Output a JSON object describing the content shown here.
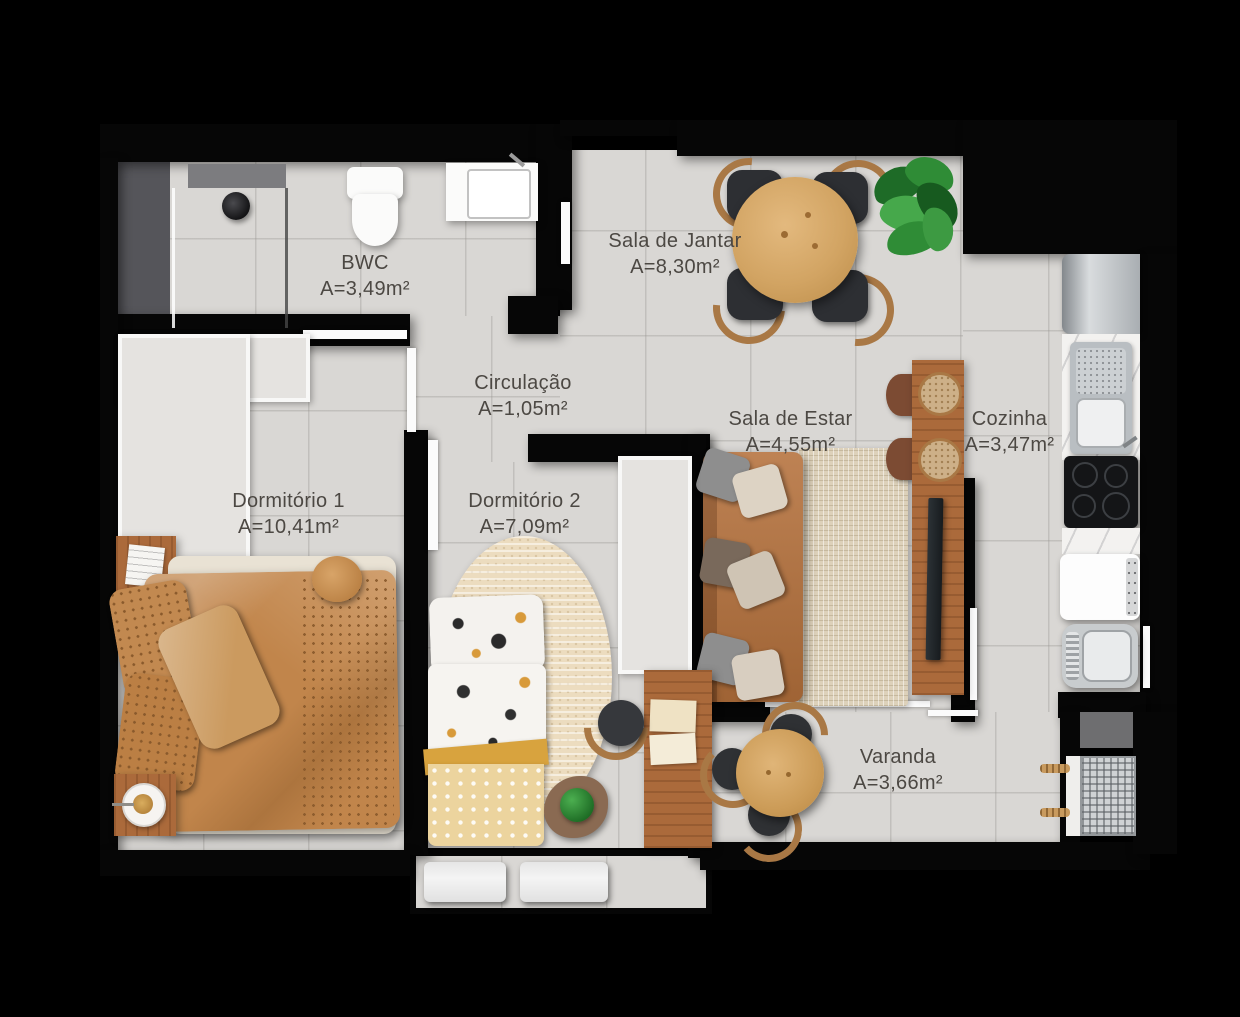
{
  "plan": {
    "title": "Apartment floor plan",
    "colors": {
      "background": "#000000",
      "floor": "#d9d7d4",
      "wall": "#060606",
      "wood": "#ab6a3b",
      "bedding_caramel": "#c1854b",
      "label_text": "#4c4843",
      "plant_green": "#2f8c36"
    },
    "rooms": [
      {
        "id": "bwc",
        "name": "BWC",
        "area": "A=3,49m²"
      },
      {
        "id": "sala_jantar",
        "name": "Sala de Jantar",
        "area": "A=8,30m²"
      },
      {
        "id": "circulacao",
        "name": "Circulação",
        "area": "A=1,05m²"
      },
      {
        "id": "sala_estar",
        "name": "Sala de Estar",
        "area": "A=4,55m²"
      },
      {
        "id": "cozinha",
        "name": "Cozinha",
        "area": "A=3,47m²"
      },
      {
        "id": "dormitorio1",
        "name": "Dormitório 1",
        "area": "A=10,41m²"
      },
      {
        "id": "dormitorio2",
        "name": "Dormitório 2",
        "area": "A=7,09m²"
      },
      {
        "id": "varanda",
        "name": "Varanda",
        "area": "A=3,66m²"
      }
    ]
  }
}
